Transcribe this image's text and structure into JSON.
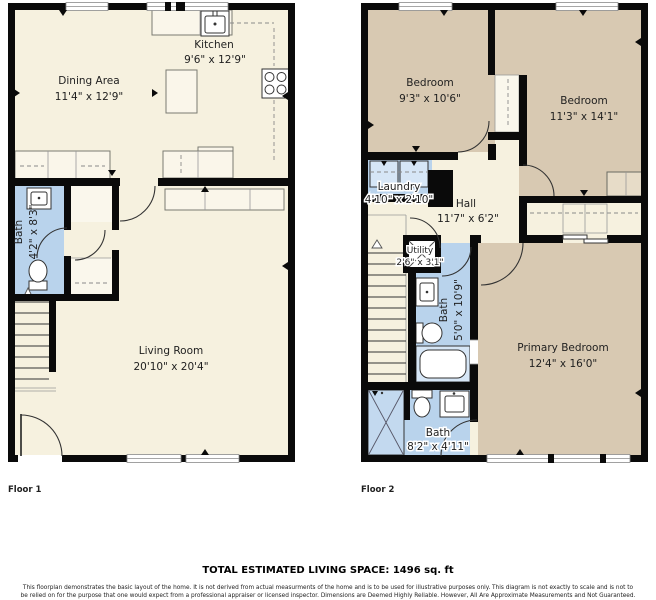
{
  "colors": {
    "cream": "#f6f1df",
    "cream_light": "#faf7ec",
    "tan": "#d8c9b2",
    "blue": "#b9d3ec",
    "blue_fixture": "#cfe2f4",
    "wall": "#0a0a0a"
  },
  "floor1": {
    "label": "Floor 1",
    "rooms": {
      "dining": {
        "name": "Dining Area",
        "dims": "11'4\" x 12'9\""
      },
      "kitchen": {
        "name": "Kitchen",
        "dims": "9'6\" x 12'9\""
      },
      "bath": {
        "name": "Bath",
        "dims": "4'2\" x 8'3\""
      },
      "living": {
        "name": "Living Room",
        "dims": "20'10\" x 20'4\""
      }
    }
  },
  "floor2": {
    "label": "Floor 2",
    "rooms": {
      "bedroom1": {
        "name": "Bedroom",
        "dims": "9'3\" x 10'6\""
      },
      "bedroom2": {
        "name": "Bedroom",
        "dims": "11'3\" x 14'1\""
      },
      "laundry": {
        "name": "Laundry",
        "dims": "4'10\" x 2'10\""
      },
      "hall": {
        "name": "Hall",
        "dims": "11'7\" x 6'2\""
      },
      "utility": {
        "name": "Utility",
        "dims": "2'6\" x 3'1\""
      },
      "bath_upper": {
        "name": "Bath",
        "dims": "5'0\" x 10'9\""
      },
      "primary": {
        "name": "Primary Bedroom",
        "dims": "12'4\" x 16'0\""
      },
      "bath_lower": {
        "name": "Bath",
        "dims": "8'2\" x 4'11\""
      }
    }
  },
  "footer": {
    "total": "TOTAL ESTIMATED LIVING SPACE: 1496 sq. ft",
    "disclaimer_line1": "This floorplan demonstrates the basic layout of the home. It is not derived from actual measurments of the home and is to be used for illustrative purposes only. This diagram is not exactly to scale and is not to",
    "disclaimer_line2": "be relied on for the purpose that one would expect from a professional appraiser or licensed inspector. Dimensions are Deemed Highly Reliable. However, All Are Approximate Measurements and Not Guaranteed."
  }
}
